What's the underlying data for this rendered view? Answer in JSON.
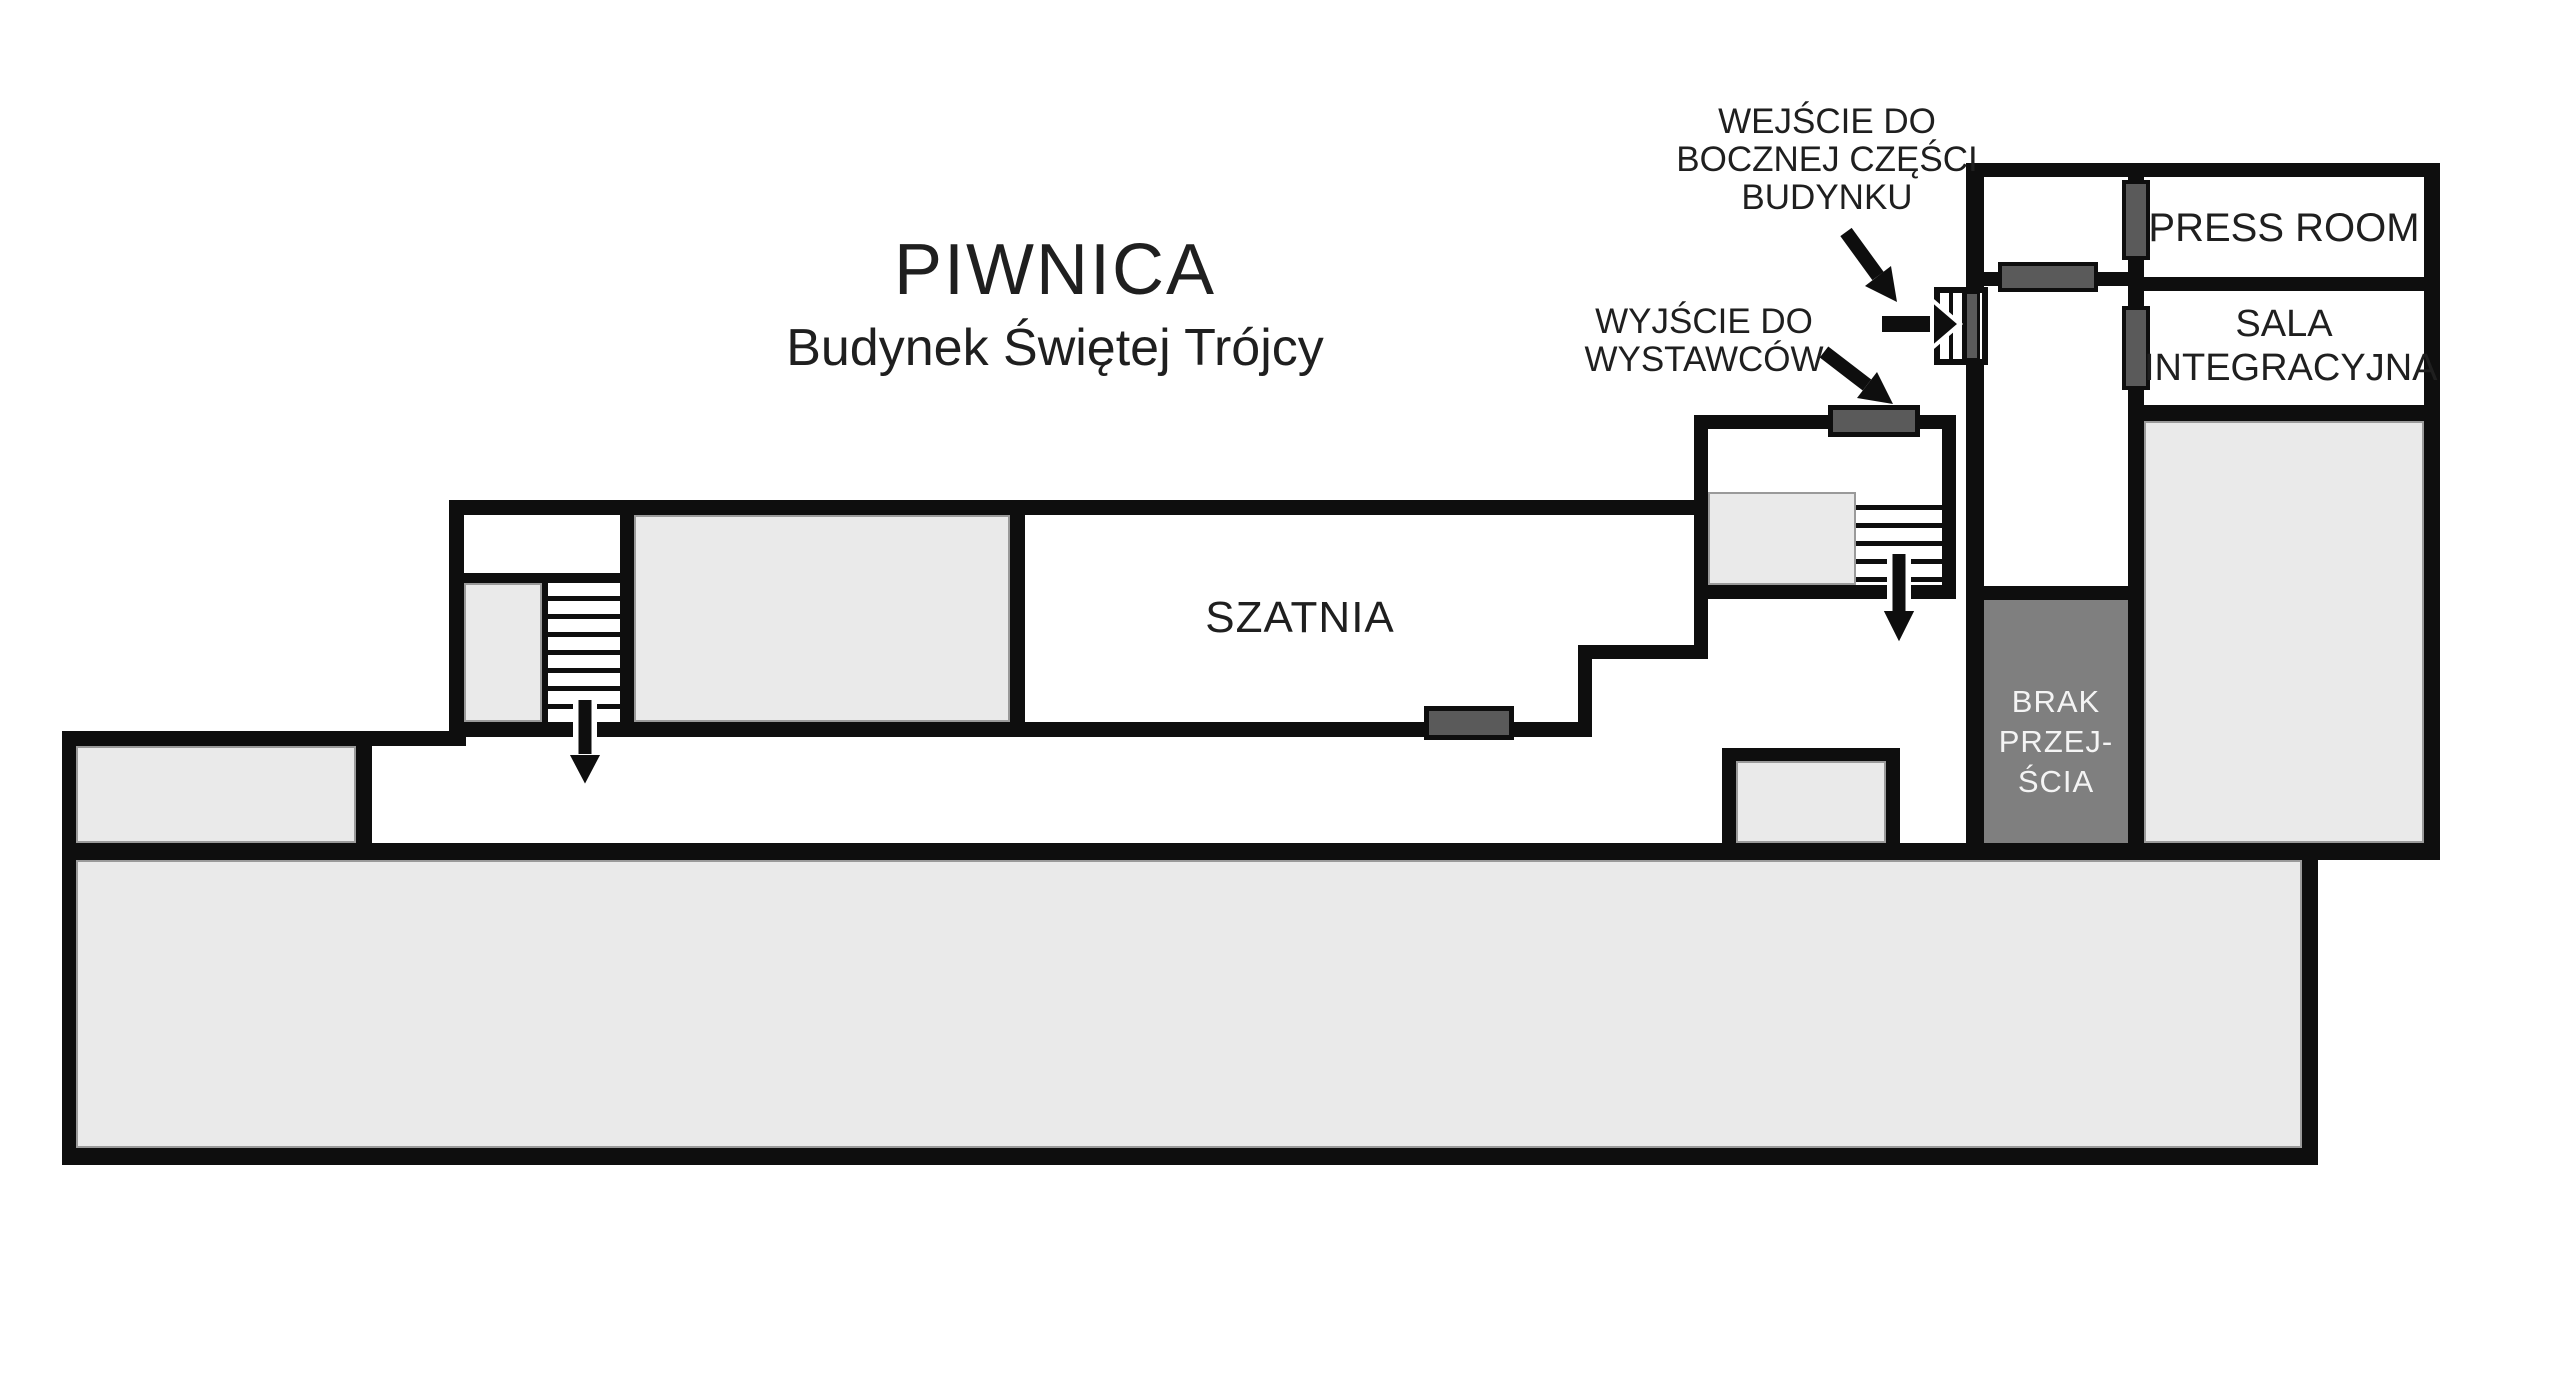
{
  "title": {
    "main": "PIWNICA",
    "subtitle": "Budynek Świętej Trójcy"
  },
  "annotations": {
    "side_entrance": {
      "line1": "WEJŚCIE DO",
      "line2": "BOCZNEJ CZĘŚCI",
      "line3": "BUDYNKU"
    },
    "exhibitor_exit": {
      "line1": "WYJŚCIE DO",
      "line2": "WYSTAWCÓW"
    }
  },
  "rooms": {
    "cloakroom": {
      "label": "SZATNIA"
    },
    "press_room": {
      "label": "PRESS ROOM"
    },
    "integration_room": {
      "line1": "SALA",
      "line2": "INTEGRACYJNA"
    },
    "no_passage": {
      "line1": "BRAK",
      "line2": "PRZEJ-",
      "line3": "ŚCIA"
    }
  },
  "icons": {
    "stairs_down_arrow": "down-arrow",
    "entrance_direction_arrow": "right-arrow",
    "label_pointer_arrow": "diagonal-arrow"
  },
  "colors": {
    "wall": "#0e0e0e",
    "room_fill": "#eaeaea",
    "room_edge": "#9a9a9a",
    "door": "#5a5a5a",
    "no_passage_fill": "#7f7f7f",
    "no_passage_text": "#f4f4f4",
    "text": "#1f1f1f",
    "background": "#ffffff"
  }
}
